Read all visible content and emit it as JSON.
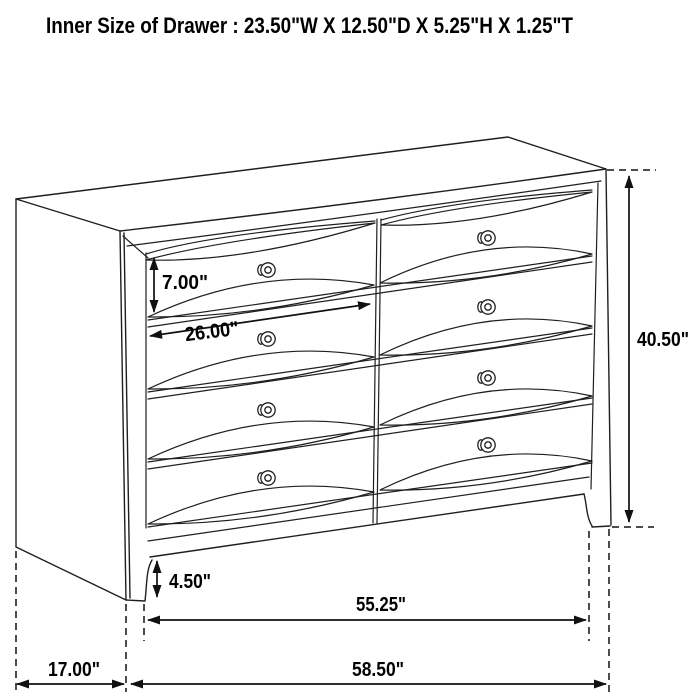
{
  "title": "Inner Size of Drawer : 23.50\"W X 12.50\"D X 5.25\"H X 1.25\"T",
  "dimensions": {
    "drawer_front_height": "7.00\"",
    "drawer_width": "26.00\"",
    "overall_height": "40.50\"",
    "foot_height": "4.50\"",
    "width_between_feet": "55.25\"",
    "depth": "17.00\"",
    "overall_width": "58.50\""
  },
  "figure": {
    "type": "dresser line drawing",
    "drawer_rows": 4,
    "drawer_columns": 2,
    "knob_count": 8
  },
  "colors": {
    "background": "#ffffff",
    "line": "#1f1f1f",
    "text": "#000000"
  }
}
